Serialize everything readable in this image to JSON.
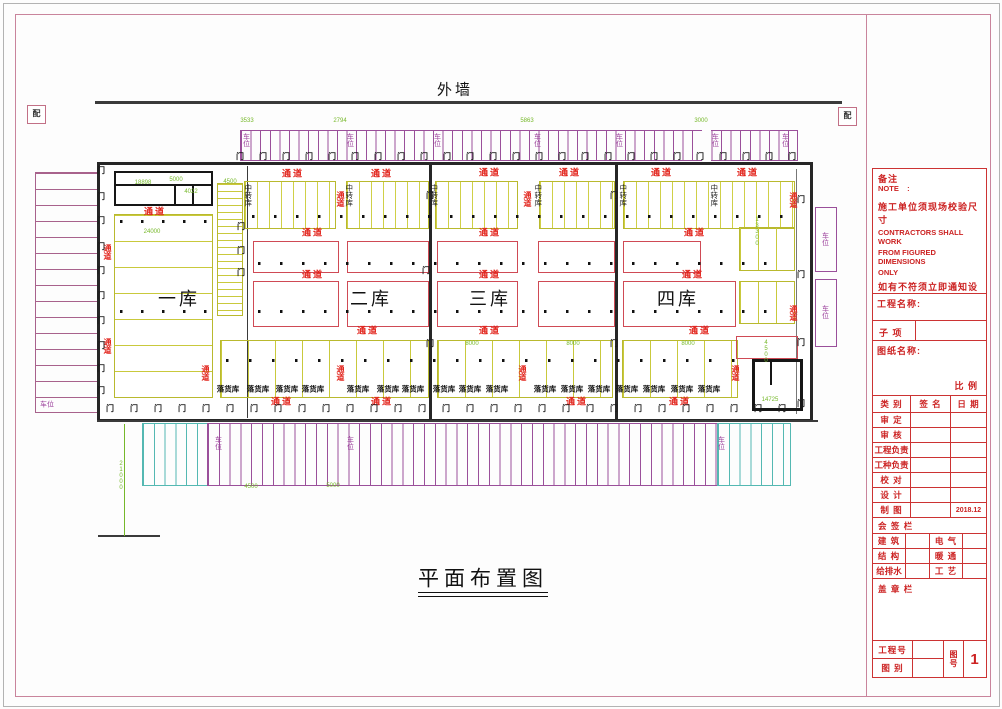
{
  "labels": {
    "exterior_wall": "外墙",
    "plan_title": "平面布置图",
    "marker": "配"
  },
  "warehouses": [
    {
      "label": "一库",
      "x": 179,
      "y": 299
    },
    {
      "label": "二库",
      "x": 371,
      "y": 299
    },
    {
      "label": "三库",
      "x": 490,
      "y": 299
    },
    {
      "label": "四库",
      "x": 678,
      "y": 299
    }
  ],
  "transfer_rooms": {
    "label": "中转库",
    "y": 195,
    "xs": [
      248,
      349,
      434,
      538,
      623,
      714
    ]
  },
  "drop_rooms": {
    "label": "落货库",
    "y": 389,
    "xs": [
      228,
      258,
      287,
      313,
      358,
      388,
      413,
      444,
      470,
      497,
      545,
      572,
      599,
      627,
      654,
      682,
      709
    ]
  },
  "corridors": {
    "label": "通道",
    "horizontal": [
      [
        293,
        174
      ],
      [
        382,
        174
      ],
      [
        490,
        173
      ],
      [
        570,
        173
      ],
      [
        662,
        173
      ],
      [
        748,
        173
      ],
      [
        155,
        212
      ],
      [
        313,
        233
      ],
      [
        490,
        233
      ],
      [
        695,
        233
      ],
      [
        313,
        275
      ],
      [
        490,
        275
      ],
      [
        693,
        275
      ],
      [
        368,
        331
      ],
      [
        490,
        331
      ],
      [
        700,
        331
      ],
      [
        282,
        402
      ],
      [
        382,
        402
      ],
      [
        577,
        402
      ],
      [
        680,
        402
      ]
    ],
    "vertical": [
      [
        107,
        252
      ],
      [
        107,
        346
      ],
      [
        340,
        199
      ],
      [
        527,
        199
      ],
      [
        793,
        200
      ],
      [
        205,
        373
      ],
      [
        340,
        373
      ],
      [
        522,
        373
      ],
      [
        735,
        373
      ],
      [
        793,
        313
      ]
    ]
  },
  "parking": {
    "label": "车位",
    "top": {
      "y": 140,
      "xs": [
        246,
        350,
        437,
        537,
        619,
        715,
        785
      ]
    },
    "left": {
      "x": 47,
      "y": 405
    },
    "right": [
      [
        825,
        239
      ],
      [
        825,
        312
      ]
    ],
    "bottom": [
      [
        218,
        443
      ],
      [
        350,
        443
      ],
      [
        721,
        443
      ]
    ]
  },
  "dims": [
    {
      "t": "3533",
      "x": 247,
      "y": 121
    },
    {
      "t": "2794",
      "x": 340,
      "y": 121
    },
    {
      "t": "5863",
      "x": 527,
      "y": 121
    },
    {
      "t": "3000",
      "x": 701,
      "y": 121
    },
    {
      "t": "18898",
      "x": 143,
      "y": 183
    },
    {
      "t": "5000",
      "x": 176,
      "y": 180
    },
    {
      "t": "4022",
      "x": 191,
      "y": 192
    },
    {
      "t": "4500",
      "x": 230,
      "y": 182
    },
    {
      "t": "24000",
      "x": 152,
      "y": 232
    },
    {
      "t": "8000",
      "x": 472,
      "y": 344
    },
    {
      "t": "8000",
      "x": 573,
      "y": 344
    },
    {
      "t": "8000",
      "x": 688,
      "y": 344
    },
    {
      "t": "13300",
      "x": 757,
      "y": 232,
      "v": true
    },
    {
      "t": "4500",
      "x": 766,
      "y": 352,
      "v": true
    },
    {
      "t": "14725",
      "x": 770,
      "y": 400
    },
    {
      "t": "4500",
      "x": 251,
      "y": 487
    },
    {
      "t": "5000",
      "x": 333,
      "y": 486
    },
    {
      "t": "21000",
      "x": 121,
      "y": 476,
      "v": true
    }
  ],
  "doors": {
    "glyph": "门",
    "rows": [
      {
        "y": 157,
        "x0": 240,
        "step": 23,
        "n": 25
      },
      {
        "y": 409,
        "x0": 110,
        "step": 24,
        "n": 29
      }
    ],
    "left_col": {
      "x": 101,
      "ys": [
        171,
        197,
        221,
        247,
        271,
        296,
        321,
        346,
        369,
        391
      ]
    },
    "right_col": {
      "x": 801,
      "ys": [
        200,
        275,
        343,
        404
      ]
    },
    "singles": [
      [
        430,
        196
      ],
      [
        614,
        196
      ],
      [
        241,
        227
      ],
      [
        241,
        251
      ],
      [
        241,
        273
      ],
      [
        426,
        271
      ],
      [
        430,
        344
      ],
      [
        614,
        344
      ]
    ]
  },
  "dots_rows": [
    {
      "y": 216,
      "x": 252,
      "w": 538,
      "step": 22
    },
    {
      "y": 221,
      "x": 120,
      "w": 92,
      "step": 21
    },
    {
      "y": 263,
      "x": 258,
      "w": 528,
      "step": 22
    },
    {
      "y": 311,
      "x": 120,
      "w": 92,
      "step": 21
    },
    {
      "y": 311,
      "x": 258,
      "w": 528,
      "step": 22
    },
    {
      "y": 360,
      "x": 226,
      "w": 520,
      "step": 23
    }
  ],
  "title_block": {
    "note_title": "备注",
    "note_en": "NOTE    :",
    "note_lines": [
      {
        "t": "施工单位须现场校验尺寸",
        "cn": true
      },
      {
        "t": "CONTRACTORS SHALL WORK"
      },
      {
        "t": "FROM FIGURED DIMENSIONS"
      },
      {
        "t": "ONLY"
      },
      {
        "t": "如有不符须立即通知设计部门",
        "cn": true
      },
      {
        "t": "CONTRACTORS MUST CHECK"
      },
      {
        "t": "ALL DIMENSIONS ON SITE"
      }
    ],
    "project_name_label": "工程名称:",
    "sub_item_label": "子 项",
    "drawing_name_label": "图纸名称:",
    "scale_label": "比 例",
    "header": [
      "类 别",
      "签 名",
      "日 期"
    ],
    "sign_rows": [
      "审 定",
      "审 核",
      "工程负责",
      "工种负责",
      "校 对",
      "设 计",
      "制 图"
    ],
    "draw_date": "2018.12",
    "countersign_label": "会 签 栏",
    "discipline_rows": [
      [
        "建 筑",
        "电 气"
      ],
      [
        "结 构",
        "暖 通"
      ],
      [
        "给排水",
        "工 艺"
      ]
    ],
    "stamp_label": "盖 章 栏",
    "project_no_label": "工程号",
    "drawing_type_label": "图 别",
    "drawing_no_label": "图号",
    "drawing_no_value": "1"
  }
}
